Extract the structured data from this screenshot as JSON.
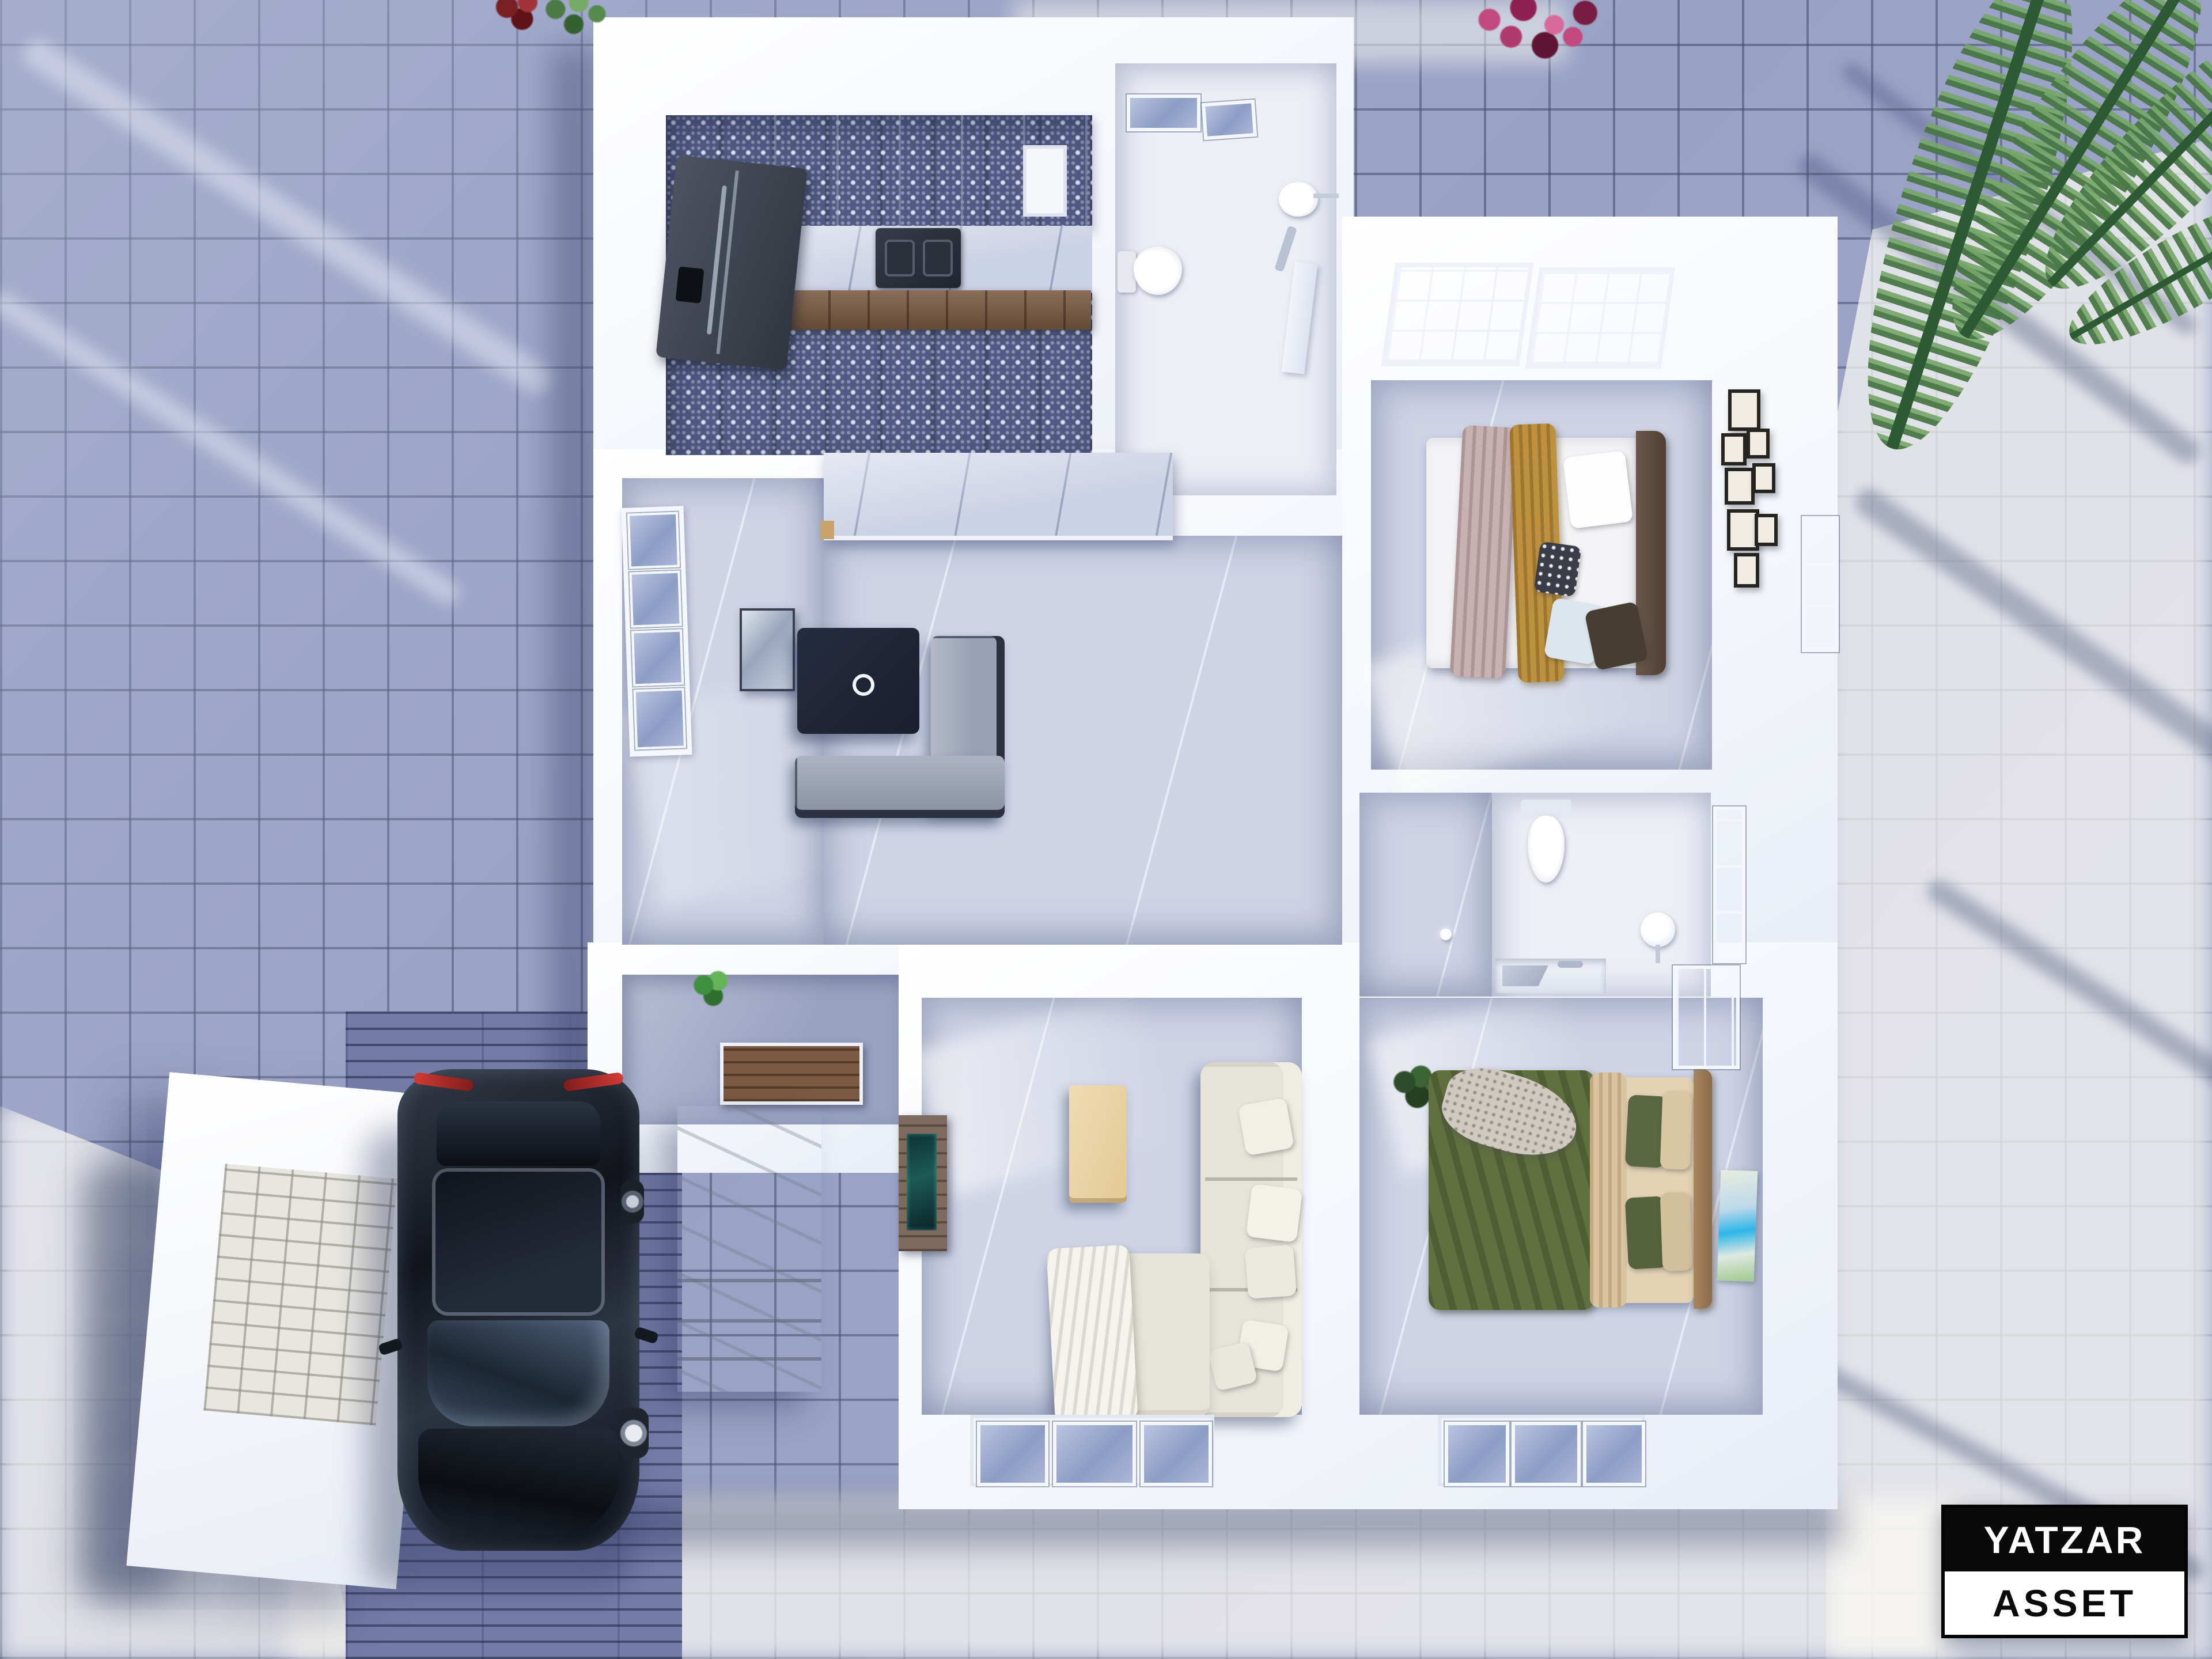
{
  "watermark": {
    "line1": "YATZAR",
    "line2": "ASSET"
  },
  "palette": {
    "tile_shadow": "#99a1c5",
    "tile_sunlit": "#eceae4",
    "wall_white": "#f5f7fb",
    "interior_floor": "#ced3e6",
    "kitchen_floor_tile": "#505a82",
    "wood_cabinet": "#7a5a42",
    "appliance_dark": "#3a414c",
    "coffee_table_navy": "#1f2433",
    "sofa_gray": "#9aa2b6",
    "sofa_white": "#e6e3d9",
    "bed_green": "#61703f",
    "bed_beige": "#d8c5a2",
    "throw_mauve": "#c9b0b2",
    "throw_mustard": "#bd9140",
    "headboard_brown": "#5c4a3e",
    "headboard_tan": "#9a7a55",
    "car_black": "#1a1d24",
    "palm_green": "#4e7c4b",
    "flower_pink": "#c2497e"
  }
}
